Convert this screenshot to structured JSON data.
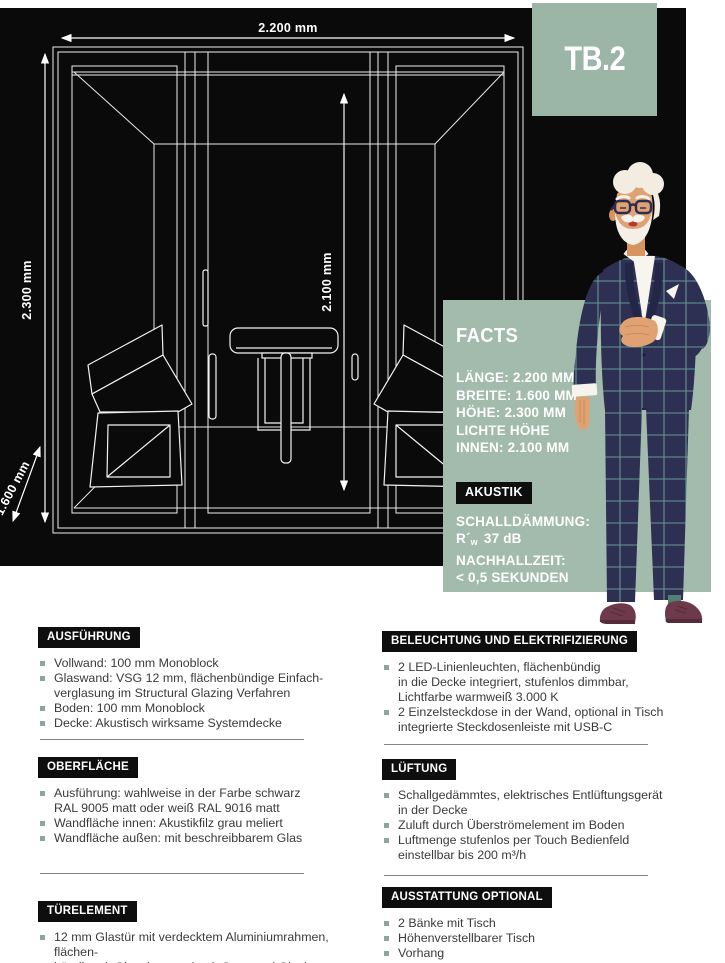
{
  "model": "TB.2",
  "drawing": {
    "width_label": "2.200 mm",
    "height_label": "2.300 mm",
    "inner_height_label": "2.100 mm",
    "depth_label": "1.600 mm"
  },
  "facts": {
    "title": "FACTS",
    "dimensions": [
      "LÄNGE: 2.200 MM",
      "BREITE: 1.600 MM",
      "HÖHE: 2.300 MM",
      "LICHTE HÖHE",
      "INNEN: 2.100 MM"
    ],
    "akustik_heading": "AKUSTIK",
    "akustik": {
      "line1": "SCHALLDÄMMUNG:",
      "rw": {
        "prefix": "R´",
        "sub": "w",
        "rest": "37 dB"
      },
      "line3": "NACHHALLZEIT:",
      "line4": "< 0,5 SEKUNDEN"
    }
  },
  "specs": {
    "left": [
      {
        "heading": "AUSFÜHRUNG",
        "items": [
          "Vollwand: 100 mm Monoblock",
          "Glaswand: VSG 12 mm, flächenbündige Einfach-\nverglasung im Structural Glazing Verfahren",
          "Boden: 100 mm Monoblock",
          "Decke: Akustisch wirksame Systemdecke"
        ]
      },
      {
        "heading": "OBERFLÄCHE",
        "items": [
          "Ausführung: wahlweise in der Farbe schwarz\nRAL 9005 matt oder weiß RAL 9016 matt",
          "Wandfläche innen: Akustikfilz grau meliert",
          "Wandfläche außen: mit beschreibbarem Glas"
        ]
      },
      {
        "heading": "TÜRELEMENT",
        "items": [
          "12 mm Glastür mit verdecktem Aluminiumrahmen, flächen-\nbündig mit Glaselement durch Structural Glazing Verfahren"
        ]
      }
    ],
    "right": [
      {
        "heading": "BELEUCHTUNG UND ELEKTRIFIZIERUNG",
        "items": [
          "2 LED-Linienleuchten, flächenbündig\nin die Decke integriert, stufenlos dimmbar,\nLichtfarbe warmweiß 3.000 K",
          "2 Einzelsteckdose in der Wand, optional in Tisch\nintegrierte Steckdosenleiste mit USB-C"
        ]
      },
      {
        "heading": "LÜFTUNG",
        "items": [
          "Schallgedämmtes, elektrisches Entlüftungsgerät\nin der Decke",
          "Zuluft durch Überströmelement im Boden",
          "Luftmenge stufenlos per Touch Bedienfeld\neinstellbar bis 200 m³/h"
        ]
      },
      {
        "heading": "AUSSTATTUNG OPTIONAL",
        "items": [
          "2 Bänke mit Tisch",
          "Höhenverstellbarer Tisch",
          "Vorhang"
        ]
      }
    ]
  },
  "colors": {
    "sage_panel": "#a2bbac",
    "sage_badge": "#9bb5a6",
    "canvas_black": "#0a0a0a",
    "heading_bg": "#0e0e0e",
    "body_text": "#3a3a3a",
    "bullet": "#8ba79b",
    "drawing_line": "#eeeeee",
    "suit_navy": "#2d3053",
    "suit_check": "#6fa89b",
    "lapel_navy": "#232647",
    "skin": "#e0a173",
    "hair_white": "#f2ece1",
    "shoe_maroon": "#6e3a4b"
  }
}
